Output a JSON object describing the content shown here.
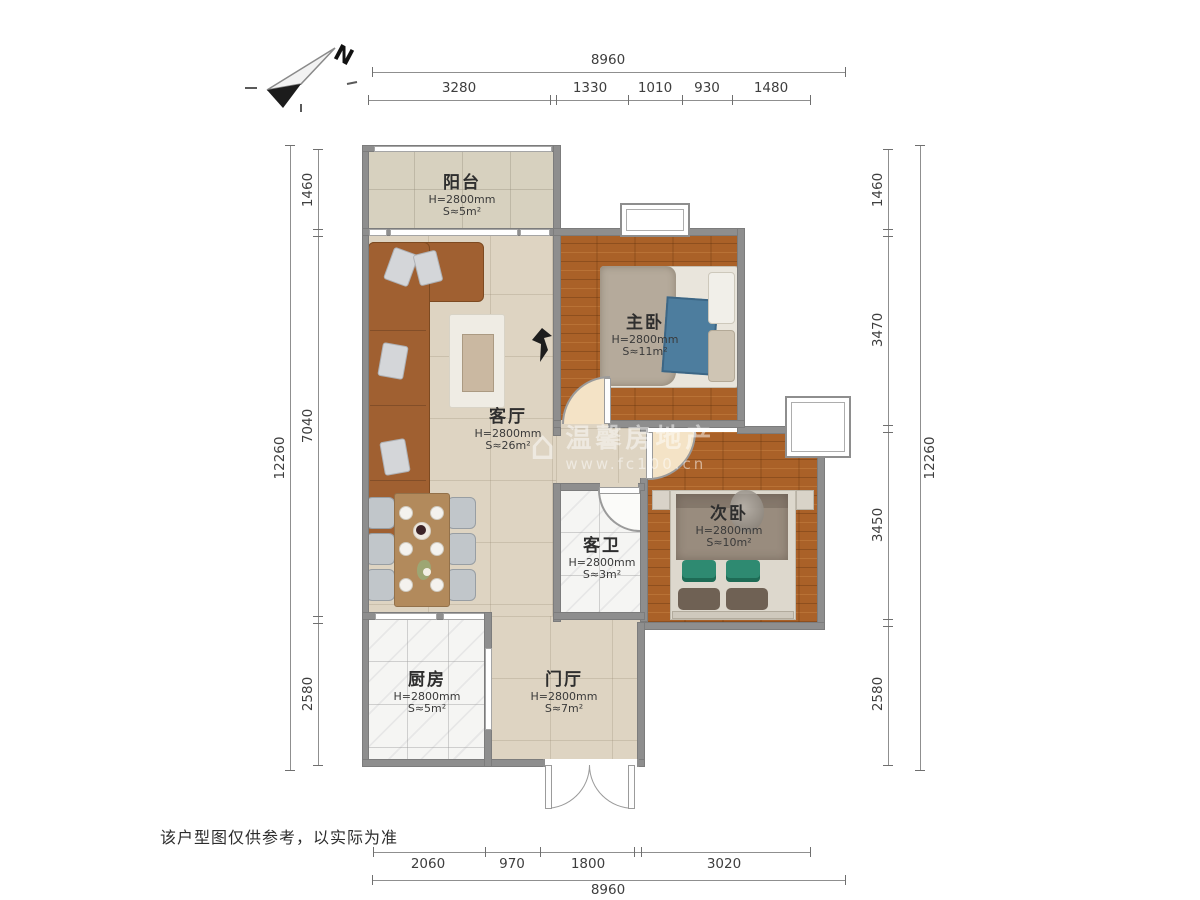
{
  "compass": {
    "label": "N"
  },
  "disclaimer": "该户型图仅供参考，以实际为准",
  "watermark": {
    "logo": "⌂",
    "line1": "温馨房地产",
    "line2": "www.fc100.cn"
  },
  "rooms": {
    "balcony": {
      "name": "阳台",
      "height": "H=2800mm",
      "area": "S≈5m²"
    },
    "living": {
      "name": "客厅",
      "height": "H=2800mm",
      "area": "S≈26m²"
    },
    "master": {
      "name": "主卧",
      "height": "H=2800mm",
      "area": "S≈11m²"
    },
    "second": {
      "name": "次卧",
      "height": "H=2800mm",
      "area": "S≈10m²"
    },
    "bath": {
      "name": "客卫",
      "height": "H=2800mm",
      "area": "S≈3m²"
    },
    "kitchen": {
      "name": "厨房",
      "height": "H=2800mm",
      "area": "S≈5m²"
    },
    "foyer": {
      "name": "门厅",
      "height": "H=2800mm",
      "area": "S≈7m²"
    }
  },
  "dimensions": {
    "top_total": "8960",
    "top": [
      "3280",
      "1330",
      "1010",
      "930",
      "1480"
    ],
    "bottom": [
      "2060",
      "970",
      "1800",
      "3020"
    ],
    "bottom_total": "8960",
    "left_total": "12260",
    "left": [
      "1460",
      "7040",
      "2580"
    ],
    "right_total": "12260",
    "right": [
      "1460",
      "3470",
      "3450",
      "2580"
    ]
  },
  "palette": {
    "wall": "#8e8e8e",
    "wood_floor": "#aa6128",
    "beige_floor": "#ded4c2",
    "marble_floor": "#f5f5f3",
    "sofa": "#a06031",
    "accent_blue": "#4d7d9e",
    "accent_green": "#2e8a71"
  }
}
